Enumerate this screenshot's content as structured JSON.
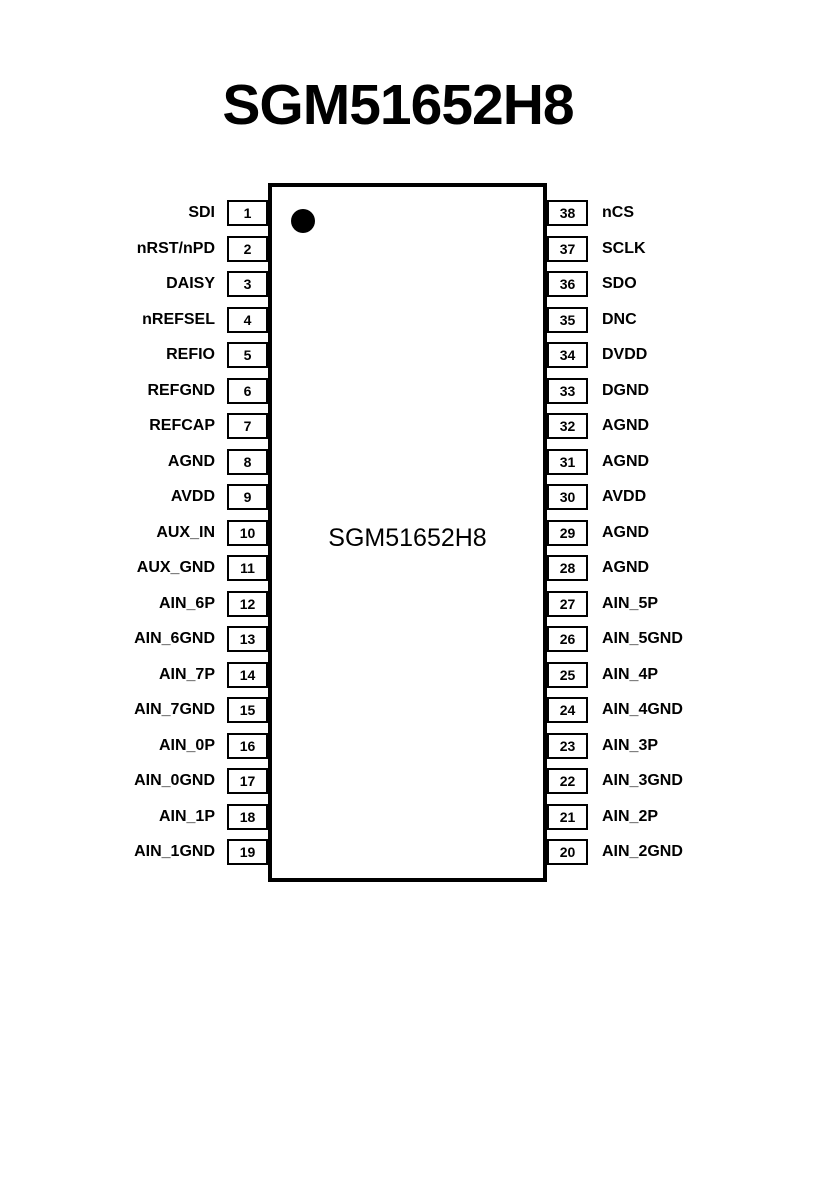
{
  "title": "SGM51652H8",
  "chip": {
    "label": "SGM51652H8"
  },
  "colors": {
    "line": "#000000",
    "background": "#ffffff"
  },
  "pins": {
    "left": [
      {
        "num": "1",
        "label": "SDI"
      },
      {
        "num": "2",
        "label": "nRST/nPD"
      },
      {
        "num": "3",
        "label": "DAISY"
      },
      {
        "num": "4",
        "label": "nREFSEL"
      },
      {
        "num": "5",
        "label": "REFIO"
      },
      {
        "num": "6",
        "label": "REFGND"
      },
      {
        "num": "7",
        "label": "REFCAP"
      },
      {
        "num": "8",
        "label": "AGND"
      },
      {
        "num": "9",
        "label": "AVDD"
      },
      {
        "num": "10",
        "label": "AUX_IN"
      },
      {
        "num": "11",
        "label": "AUX_GND"
      },
      {
        "num": "12",
        "label": "AIN_6P"
      },
      {
        "num": "13",
        "label": "AIN_6GND"
      },
      {
        "num": "14",
        "label": "AIN_7P"
      },
      {
        "num": "15",
        "label": "AIN_7GND"
      },
      {
        "num": "16",
        "label": "AIN_0P"
      },
      {
        "num": "17",
        "label": "AIN_0GND"
      },
      {
        "num": "18",
        "label": "AIN_1P"
      },
      {
        "num": "19",
        "label": "AIN_1GND"
      }
    ],
    "right": [
      {
        "num": "38",
        "label": "nCS"
      },
      {
        "num": "37",
        "label": "SCLK"
      },
      {
        "num": "36",
        "label": "SDO"
      },
      {
        "num": "35",
        "label": "DNC"
      },
      {
        "num": "34",
        "label": "DVDD"
      },
      {
        "num": "33",
        "label": "DGND"
      },
      {
        "num": "32",
        "label": "AGND"
      },
      {
        "num": "31",
        "label": "AGND"
      },
      {
        "num": "30",
        "label": "AVDD"
      },
      {
        "num": "29",
        "label": "AGND"
      },
      {
        "num": "28",
        "label": "AGND"
      },
      {
        "num": "27",
        "label": "AIN_5P"
      },
      {
        "num": "26",
        "label": "AIN_5GND"
      },
      {
        "num": "25",
        "label": "AIN_4P"
      },
      {
        "num": "24",
        "label": "AIN_4GND"
      },
      {
        "num": "23",
        "label": "AIN_3P"
      },
      {
        "num": "22",
        "label": "AIN_3GND"
      },
      {
        "num": "21",
        "label": "AIN_2P"
      },
      {
        "num": "20",
        "label": "AIN_2GND"
      }
    ]
  }
}
